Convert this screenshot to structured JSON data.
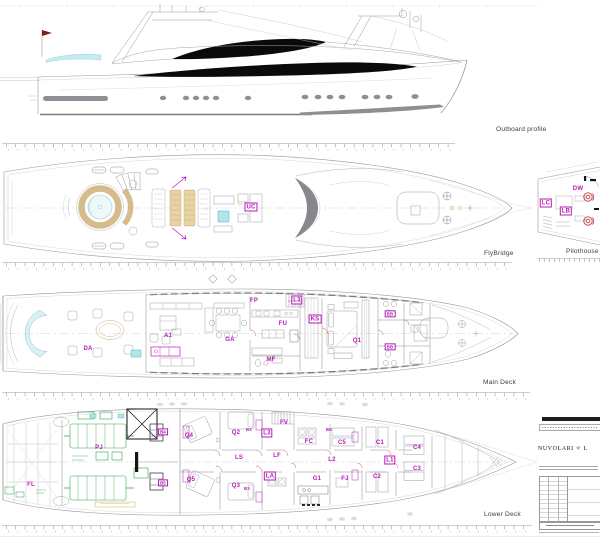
{
  "captions": {
    "outboard": "Outboard profile",
    "flybridge": "FlyBridge",
    "pilothouse": "Pilothouse",
    "main": "Main Deck",
    "lower": "Lower Deck"
  },
  "titleblock": {
    "brand": "NUVOLARI ✧ L"
  },
  "colors": {
    "label_magenta": "#b51db5",
    "machinery_green": "#2da44e",
    "water_cyan": "#aee6ea",
    "teak_tan": "#d6bb8d",
    "helm_red": "#c43b3b",
    "window_black": "#0a0a0a"
  },
  "room_labels": {
    "flybridge": [
      {
        "t": "UC",
        "x": 251,
        "y": 207,
        "boxed": true
      }
    ],
    "pilothouse": [
      {
        "t": "DW",
        "x": 578,
        "y": 189
      },
      {
        "t": "LC",
        "x": 546,
        "y": 203,
        "boxed": true
      },
      {
        "t": "LB",
        "x": 566,
        "y": 211,
        "boxed": true
      }
    ],
    "main": [
      {
        "t": "DA",
        "x": 88,
        "y": 349
      },
      {
        "t": "A1",
        "x": 168,
        "y": 336
      },
      {
        "t": "GA",
        "x": 230,
        "y": 340
      },
      {
        "t": "FP",
        "x": 254,
        "y": 301
      },
      {
        "t": "L3",
        "x": 297,
        "y": 300,
        "boxed": true
      },
      {
        "t": "FU",
        "x": 283,
        "y": 324
      },
      {
        "t": "KS",
        "x": 315,
        "y": 319,
        "boxed": true
      },
      {
        "t": "MF",
        "x": 271,
        "y": 360
      },
      {
        "t": "Q1",
        "x": 357,
        "y": 341
      },
      {
        "t": "BB",
        "x": 390,
        "y": 314,
        "boxed": true,
        "small": true
      },
      {
        "t": "BB",
        "x": 390,
        "y": 347,
        "boxed": true,
        "small": true
      }
    ],
    "lower": [
      {
        "t": "FL",
        "x": 31,
        "y": 485
      },
      {
        "t": "PJ",
        "x": 99,
        "y": 448
      },
      {
        "t": "B4",
        "x": 163,
        "y": 432,
        "boxed": true,
        "small": true
      },
      {
        "t": "B5",
        "x": 163,
        "y": 483,
        "boxed": true,
        "small": true
      },
      {
        "t": "Q4",
        "x": 189,
        "y": 436
      },
      {
        "t": "Q5",
        "x": 191,
        "y": 480
      },
      {
        "t": "Q2",
        "x": 236,
        "y": 433
      },
      {
        "t": "Q3",
        "x": 236,
        "y": 486
      },
      {
        "t": "LS",
        "x": 239,
        "y": 458
      },
      {
        "t": "L3",
        "x": 267,
        "y": 433,
        "boxed": true
      },
      {
        "t": "B2",
        "x": 249,
        "y": 430,
        "small": true
      },
      {
        "t": "B3",
        "x": 247,
        "y": 489,
        "small": true
      },
      {
        "t": "FV",
        "x": 284,
        "y": 423
      },
      {
        "t": "LF",
        "x": 277,
        "y": 456
      },
      {
        "t": "LA",
        "x": 270,
        "y": 476,
        "boxed": true
      },
      {
        "t": "FC",
        "x": 309,
        "y": 442
      },
      {
        "t": "C5",
        "x": 342,
        "y": 443
      },
      {
        "t": "L2",
        "x": 332,
        "y": 460
      },
      {
        "t": "BE",
        "x": 329,
        "y": 430,
        "small": true
      },
      {
        "t": "G1",
        "x": 317,
        "y": 479
      },
      {
        "t": "FJ",
        "x": 345,
        "y": 479
      },
      {
        "t": "C1",
        "x": 380,
        "y": 443
      },
      {
        "t": "C2",
        "x": 377,
        "y": 477
      },
      {
        "t": "L1",
        "x": 390,
        "y": 460,
        "boxed": true
      },
      {
        "t": "C4",
        "x": 417,
        "y": 448
      },
      {
        "t": "C3",
        "x": 417,
        "y": 469
      }
    ]
  }
}
